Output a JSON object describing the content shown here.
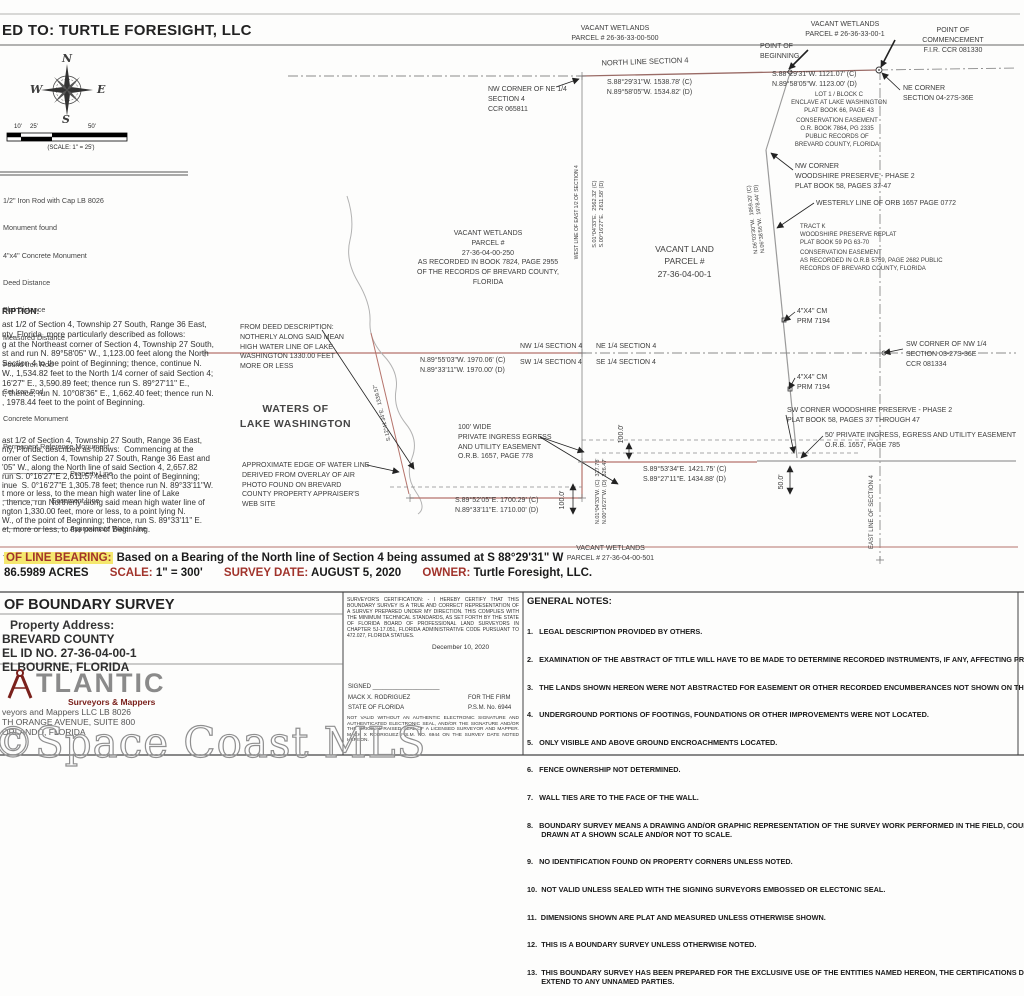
{
  "page": {
    "certified_to": "ED TO:  TURTLE FORESIGHT, LLC"
  },
  "compass": {
    "north": "N",
    "south": "S",
    "east": "E",
    "west": "W"
  },
  "scale_bar": {
    "ticks": [
      "10'",
      "25'",
      "50'"
    ],
    "caption": "(SCALE:  1\" = 25')"
  },
  "legend": {
    "items": [
      "1/2\" Iron Rod with Cap LB 8026",
      "Monument found",
      "4\"x4\" Concrete Monument",
      "Deed Distance",
      "Plat Distance",
      "Measured Distance",
      "Found Iron Rod",
      "Set Iron Rod",
      "Concrete Monument",
      "Permanent Reference Monument",
      "────────────   Property Line",
      "─ ─ ─ ─ ─ ─    Easement Line",
      "────────────   Approximate Water Line",
      "── ─ ── ─ ──   Section Line"
    ]
  },
  "description": {
    "heading": "RIPTION:",
    "paragraph1": [
      "ast 1/2 of Section 4, Township 27 South, Range 36 East,",
      "nty, Florida, more particularly described as follows:",
      "g at the Northeast corner of Section 4, Township 27 South,",
      "st and run N. 89°58'05\" W., 1,123.00 feet along the North",
      "Section 4 to the point of Beginning; thence, continue N.",
      "W., 1,534.82 feet to the North 1/4 corner of said Section 4;",
      "16'27\" E., 3,590.89 feet; thence run S. 89°27'11\" E.,",
      "t; thence, run N. 10°08'36\" E., 1,662.40 feet; thence run N.",
      ", 1978.44 feet to the point of Beginning."
    ],
    "paragraph2": [
      "ast 1/2 of Section 4, Township 27 South, Range 36 East,",
      "nty, Florida, described as follows:  Commencing at the",
      "orner of Section 4, Township 27 South, Range 36 East and",
      "'05\" W., along the North line of said Section 4, 2,657.82",
      "run S. 0°16'27\"E 2,611.57 feet to the point of Beginning;",
      "inue  S. 0°16'27\"E 1,305.78 feet; thence run N. 89°33'11\"W.",
      "t more or less, to the mean high water line of Lake",
      "; thence, run Northerly along said mean high water line of",
      "ngton 1,330.00 feet, more or less, to a point lying N.",
      "W., of the point of Beginning; thence, run S. 89°33'11\" E.",
      "et, more or less, to the point of Beginning."
    ]
  },
  "map_labels": {
    "vacant500": [
      "VACANT WETLANDS",
      "PARCEL # 26-36-33-00-500"
    ],
    "vacant1": [
      "VACANT WETLANDS",
      "PARCEL # 26-36-33-00-1"
    ],
    "pob": [
      "POINT OF",
      "BEGINNING"
    ],
    "poc": [
      "POINT OF",
      "COMMENCEMENT",
      "F.I.R.  CCR 081330"
    ],
    "north_line": [
      "NORTH LINE SECTION 4"
    ],
    "nl_bearing_w": [
      "S.88°29'31\"W.  1538.78' (C)",
      "N.89°58'05\"W.  1534.82' (D)"
    ],
    "nl_bearing_e": [
      "S.88°29'31\"W.  1121.07' (C)",
      "N.89°58'05\"W.  1123.00' (D)"
    ],
    "ne_corner": [
      "NE CORNER",
      "SECTION 04-27S-36E"
    ],
    "nw_corner_ne4": [
      "NW CORNER OF NE 1/4",
      "SECTION 4",
      "CCR 065811"
    ],
    "lot1": [
      "LOT 1 / BLOCK C",
      "ENCLAVE AT LAKE WASHINGTON",
      "PLAT BOOK 66, PAGE 43"
    ],
    "cons_ease_ne": [
      "CONSERVATION EASEMENT",
      "O.R. BOOK 7864, PG 2335",
      "PUBLIC RECORDS OF",
      "BREVARD COUNTY, FLORIDA"
    ],
    "nw_woodshire": [
      "NW CORNER",
      "WOODSHIRE PRESERVE - PHASE 2",
      "PLAT BOOK 58, PAGES 37-47"
    ],
    "westerly_line": [
      "WESTERLY LINE OF ORB 1657 PAGE 0772"
    ],
    "tract_k": [
      "TRACT K",
      "WOODSHIRE PRESERVE REPLAT",
      "PLAT BOOK 59 PG 63-70"
    ],
    "cons_ease_5759": [
      "CONSERVATION EASEMENT",
      "AS RECORDED IN O.R.B 5759, PAGE 2682 PUBLIC",
      "RECORDS OF BREVARD COUNTY, FLORIDA"
    ],
    "vacant250": [
      "VACANT WETLANDS",
      "PARCEL #",
      "27-36-04-00-250",
      "AS RECORDED IN BOOK 7824, PAGE 2955",
      "OF THE RECORDS OF BREVARD COUNTY,",
      "FLORIDA"
    ],
    "vacant_land": [
      "VACANT LAND",
      "PARCEL #",
      "27-36-04-00-1"
    ],
    "west_line_rot": [
      "WEST LINE OF EAST 1/2 OF SECTION 4"
    ],
    "west_line_bearing_rot": [
      "S.01°04'33\"E.  2562.32' (C)",
      "S.00°16'27\"E.  2611.58' (D)"
    ],
    "n06_bearing_rot": [
      "N.06°03'30\"W.  1959.20' (C)",
      "N.06°38'56\"W.  1978.44' (D)"
    ],
    "cm_top": [
      "4\"X4\" CM",
      "PRM  7194"
    ],
    "cm_bottom": [
      "4\"X4\" CM",
      "PRM  7194"
    ],
    "sw_corner_nw4": [
      "SW CORNER OF NW  1/4",
      "SECTION 03-27S-36E",
      "CCR 081334"
    ],
    "from_deed": [
      "FROM DEED DESCRIPTION:",
      "NOTHERLY ALONG SAID MEAN",
      "HIGH WATER LINE OF LAKE",
      "WASHINGTON 1330.00 FEET",
      "MORE OR LESS"
    ],
    "q_nw": [
      "NW 1/4 SECTION 4"
    ],
    "q_ne": [
      "NE 1/4 SECTION 4"
    ],
    "q_sw": [
      "SW 1/4 SECTION 4"
    ],
    "q_se": [
      "SE 1/4 SECTION 4"
    ],
    "q_bearing": [
      "N.89°55'03\"W.  1970.06' (C)",
      "N.89°33'11\"W.  1970.00' (D)"
    ],
    "waters": [
      "WATERS OF",
      "LAKE WASHINGTON"
    ],
    "approx_edge": [
      "APPROXIMATE EDGE OF WATER LINE",
      "DERIVED FROM OVERLAY OF AIR",
      "PHOTO FOUND ON BREVARD",
      "COUNTY PROPERTY APPRAISER'S",
      "WEB SITE"
    ],
    "shore_bearing_rot": [
      "S.12°41'34\"E.  1339.57'"
    ],
    "ease100": [
      "100' WIDE",
      "PRIVATE INGRESS EGRESS",
      "AND UTILITY EASEMENT",
      "O.R.B. 1657, PAGE 778"
    ],
    "b1421": [
      "S.89°53'34\"E.  1421.75' (C)",
      "S.89°27'11\"E.  1434.88' (D)"
    ],
    "b1700": [
      "S.89°52'05\"E.  1700.29' (C)",
      "N.89°33'11\"E.  1710.00' (D)"
    ],
    "vert_327": [
      "N.01°04'33\"W. (C)  327.78'",
      "N.00°16'27\"W. (D)  326.47'"
    ],
    "dim100a": [
      "100.0'"
    ],
    "dim100b": [
      "100.0'"
    ],
    "dim50": [
      "50.0'"
    ],
    "east_line_rot": [
      "EAST LINE OF SECTION 4"
    ],
    "sw_woodshire": [
      "SW CORNER WOODSHIRE PRESERVE - PHASE 2",
      "PLAT BOOK 58, PAGES 37 THROUGH 47"
    ],
    "ease50": [
      "50' PRIVATE INGRESS, EGRESS AND UTILITY EASEMENT",
      "O.R.B. 1657, PAGE 785"
    ],
    "vacant501": [
      "VACANT WETLANDS",
      "PARCEL # 27-36-04-00-501"
    ]
  },
  "survey_info": {
    "bearing_label": "OF LINE BEARING:",
    "bearing_text": "Based on a Bearing of the North line of Section 4 being assumed at S 88°29'31\" W",
    "area": "86.5989 ACRES",
    "scale_label": "SCALE:",
    "scale_value": "1\" = 300'",
    "date_label": "SURVEY DATE:",
    "date_value": "AUGUST 5, 2020",
    "owner_label": "OWNER:",
    "owner_value": "Turtle Foresight, LLC."
  },
  "title_block": {
    "title": "OF BOUNDARY SURVEY",
    "property_address_label": "Property Address:",
    "county": "BREVARD COUNTY",
    "parcel_id": "EL ID NO. 27-36-04-00-1",
    "city": "ELBOURNE, FLORIDA",
    "firm_name": "TLANTIC",
    "firm_tagline": "Surveyors & Mappers",
    "firm_line1": "veyors  and  Mappers  LLC  LB  8026",
    "firm_line2": "TH ORANGE AVENUE, SUITE 800",
    "firm_line3": "ORLANDO, FLORIDA"
  },
  "certification": {
    "body": "SURVEYOR'S CERTIFICATION: - I HEREBY CERTIFY THAT THIS BOUNDARY SURVEY IS A TRUE AND CORRECT REPRESENTATION OF A SURVEY PREPARED UNDER MY DIRECTION. THIS COMPLIES WITH THE MINIMUM TECHNICAL STANDARDS, AS SET FORTH BY THE STATE OF FLORIDA BOARD OF PROFESSIONAL LAND SURVEYORS IN CHAPTER 5J-17.051, FLORIDA ADMINISTRATIVE CODE PURSUANT TO 472.027, FLORIDA STATUES.",
    "date": "December 10, 2020",
    "signed_label": "SIGNED  ____________________",
    "surveyor": "MACK X. RODRIGUEZ",
    "firm_role": "FOR THE FIRM",
    "state": "STATE OF FLORIDA",
    "license": "P.S.M. No. 6944",
    "disclaimer": "NOT VALID WITHOUT AN AUTHENTIC ELECTRONIC SIGNATURE AND AUTHENTICATED ELECTRONIC SEAL, AND/OR THE SIGNATURE AND/OR THE ORIGINAL RAISED SEAL OF A LICENSED SURVEYOR AND MAPPER. MACK X RODRIGUEZ P.S.M. NO. 6944 ON THE SURVEY DATE NOTED HEREON."
  },
  "general_notes": {
    "heading": "GENERAL NOTES:",
    "items": [
      "1.   LEGAL DESCRIPTION PROVIDED BY OTHERS.",
      "2.   EXAMINATION OF THE ABSTRACT OF TITLE WILL HAVE TO BE MADE TO DETERMINE RECORDED INSTRUMENTS, IF ANY, AFFECTING PROPERTY.",
      "3.   THE LANDS SHOWN HEREON WERE NOT ABSTRACTED FOR EASEMENT OR OTHER RECORDED ENCUMBERANCES NOT SHOWN ON THE PLAT.",
      "4.   UNDERGROUND PORTIONS OF FOOTINGS, FOUNDATIONS OR OTHER IMPROVEMENTS WERE NOT LOCATED.",
      "5.   ONLY VISIBLE AND ABOVE GROUND ENCROACHMENTS LOCATED.",
      "6.   FENCE OWNERSHIP NOT DETERMINED.",
      "7.   WALL TIES ARE TO THE FACE OF THE WALL.",
      "8.   BOUNDARY SURVEY MEANS A DRAWING AND/OR GRAPHIC REPRESENTATION OF THE SURVEY WORK PERFORMED IN THE FIELD, COULD BE\n       DRAWN AT A SHOWN SCALE AND/OR NOT TO SCALE.",
      "9.   NO IDENTIFICATION FOUND ON PROPERTY CORNERS UNLESS NOTED.",
      "10.  NOT VALID UNLESS SEALED WITH THE SIGNING SURVEYORS EMBOSSED OR ELECTONIC SEAL.",
      "11.  DIMENSIONS SHOWN ARE PLAT AND MEASURED UNLESS OTHERWISE SHOWN.",
      "12.  THIS IS A BOUNDARY SURVEY UNLESS OTHERWISE NOTED.",
      "13.  THIS BOUNDARY SURVEY HAS BEEN PREPARED FOR THE EXCLUSIVE USE OF THE ENTITIES NAMED HEREON, THE CERTIFICATIONS DO NOT\n       EXTEND TO ANY UNNAMED PARTIES."
    ]
  },
  "watermark": "©Space Coast MLS"
}
